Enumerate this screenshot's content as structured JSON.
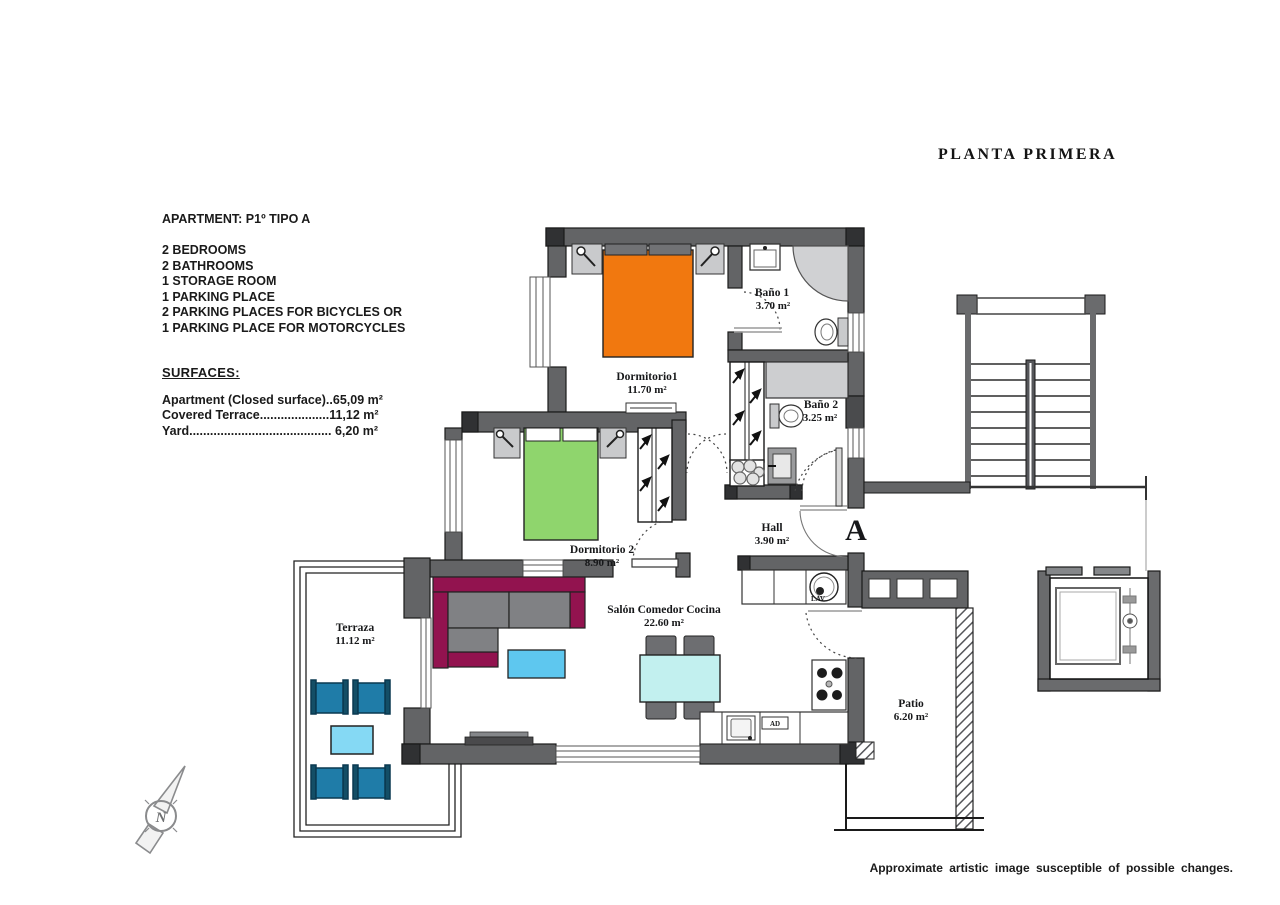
{
  "title": "PLANTA  PRIMERA",
  "info": {
    "apartment": "APARTMENT: P1º TIPO A",
    "features": [
      "2 BEDROOMS",
      "2 BATHROOMS",
      "1 STORAGE ROOM",
      "1 PARKING PLACE",
      "2 PARKING PLACES FOR BICYCLES OR",
      "1 PARKING PLACE FOR MOTORCYCLES"
    ],
    "surfaces_heading": "SURFACES:",
    "surfaces": [
      "Apartment (Closed surface)..65,09 m²",
      "Covered Terrace....................11,12 m²",
      "Yard.........................................  6,20 m²"
    ]
  },
  "rooms": [
    {
      "id": "dormitorio1",
      "name": "Dormitorio1",
      "area": "11.70 m²"
    },
    {
      "id": "bano1",
      "name": "Baño 1",
      "area": "3.70 m²"
    },
    {
      "id": "bano2",
      "name": "Baño 2",
      "area": "3.25 m²"
    },
    {
      "id": "dormitorio2",
      "name": "Dormitorio 2",
      "area": "8.90 m²"
    },
    {
      "id": "hall",
      "name": "Hall",
      "area": "3.90 m²"
    },
    {
      "id": "salon",
      "name": "Salón Comedor Cocina",
      "area": "22.60 m²"
    },
    {
      "id": "terraza",
      "name": "Terraza",
      "area": "11.12 m²"
    },
    {
      "id": "patio",
      "name": "Patio",
      "area": "6.20 m²"
    }
  ],
  "entrance_label": "A",
  "appliances": {
    "washer": "LAV",
    "dishwasher": "AD"
  },
  "compass_label": "N",
  "disclaimer": "Approximate artistic image susceptible of possible changes.",
  "colors": {
    "wall": "#636466",
    "wall_cap": "#303133",
    "bed1": "#f1780f",
    "bed2": "#8fd56d",
    "sofa": "#92134f",
    "cushion": "#808184",
    "coffee_table": "#5ec7ef",
    "dining_table": "#c2f0ef",
    "terrace_chair": "#1f7ca8",
    "terrace_table": "#85d9f4",
    "fixture_gray": "#cdced0"
  }
}
